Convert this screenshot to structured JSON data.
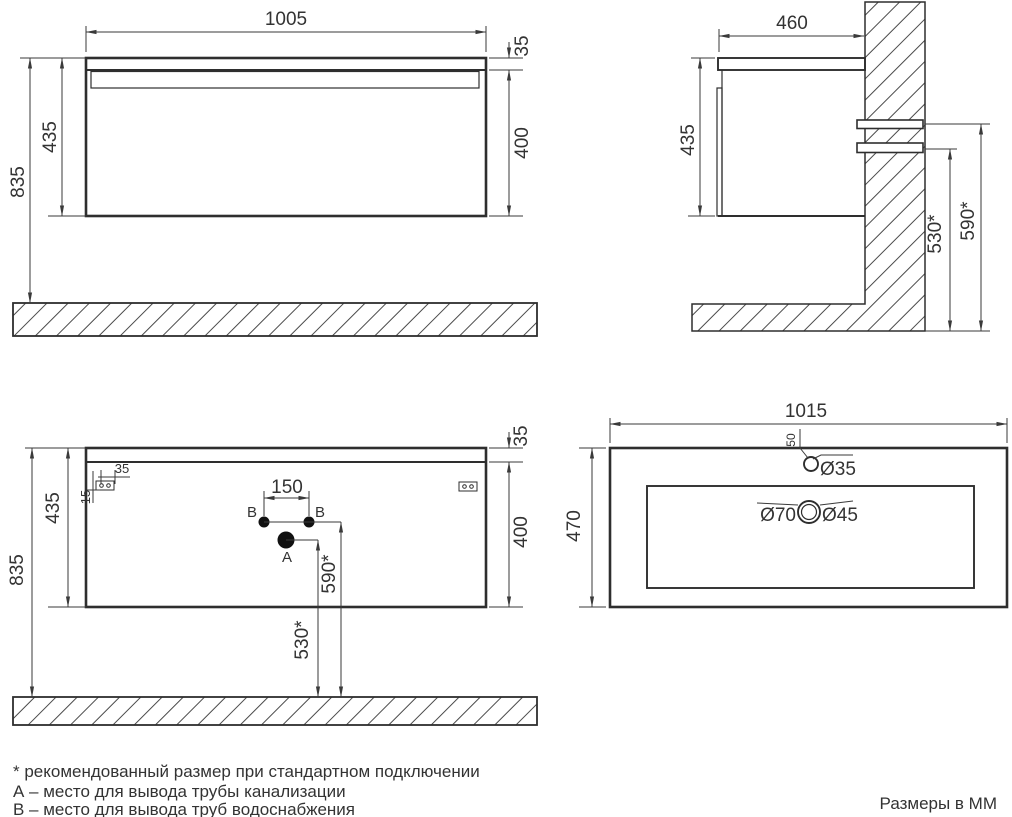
{
  "front_view": {
    "width": "1005",
    "top_thickness": "35",
    "front_height": "400",
    "cabinet_height": "435",
    "mount_height": "835"
  },
  "side_view": {
    "depth": "460",
    "cabinet_height": "435",
    "drain_height": "530*",
    "supply_height": "590*"
  },
  "back_view": {
    "mount_height": "835",
    "cabinet_height": "435",
    "top_thickness": "35",
    "front_height": "400",
    "bracket_width": "35",
    "bracket_offset": "15",
    "supply_spacing": "150",
    "label_b_left": "B",
    "label_b_right": "B",
    "label_a": "A",
    "supply_height": "590*",
    "drain_height": "530*"
  },
  "top_view": {
    "width": "1015",
    "depth": "470",
    "faucet_offset": "50",
    "faucet_diameter": "Ø35",
    "drain_outer_diameter": "Ø70",
    "drain_inner_diameter": "Ø45"
  },
  "notes": {
    "asterisk": "* рекомендованный размер при стандартном подключении",
    "a": "А – место для вывода трубы канализации",
    "b": "B – место для вывода труб водоснабжения",
    "units": "Размеры в ММ"
  },
  "colors": {
    "line": "#2e2e2e",
    "background": "#ffffff"
  }
}
